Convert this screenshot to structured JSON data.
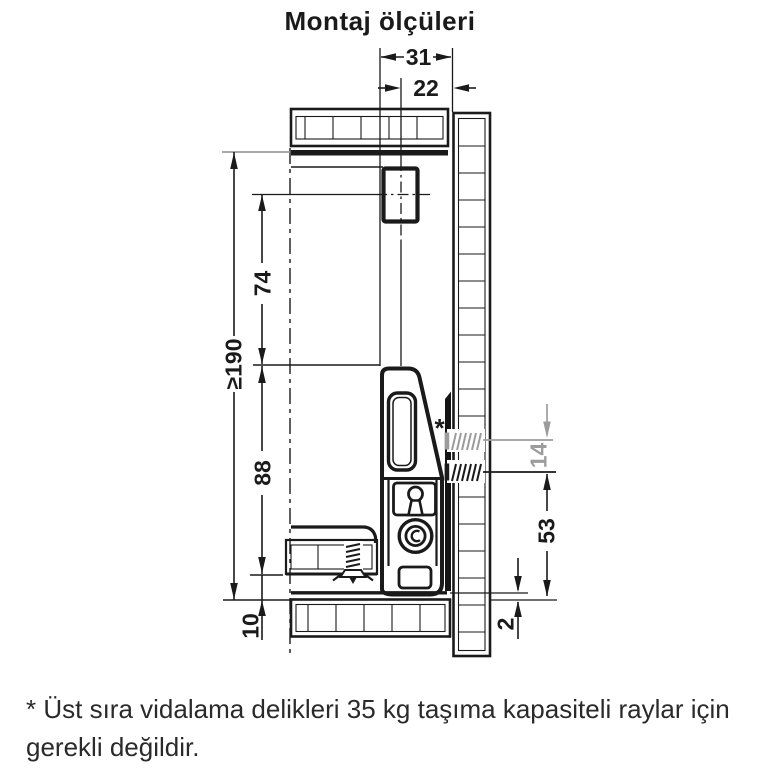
{
  "title": "Montaj ölçüleri",
  "diagram": {
    "dim_labels": {
      "width_31": "31",
      "width_22": "22",
      "height_min_190": "≥190",
      "height_74": "74",
      "height_88": "88",
      "height_10": "10",
      "height_14": "14",
      "height_53": "53",
      "gap_2": "2",
      "asterisk_marker": "*"
    },
    "colors": {
      "line": "#1a1a1a",
      "optional_gray": "#9c9c9c"
    }
  },
  "footnote": {
    "lines": [
      "* Üst sıra vidalama delikleri 35 kg taşıma kapasiteli raylar için",
      "gerekli değildir."
    ]
  }
}
